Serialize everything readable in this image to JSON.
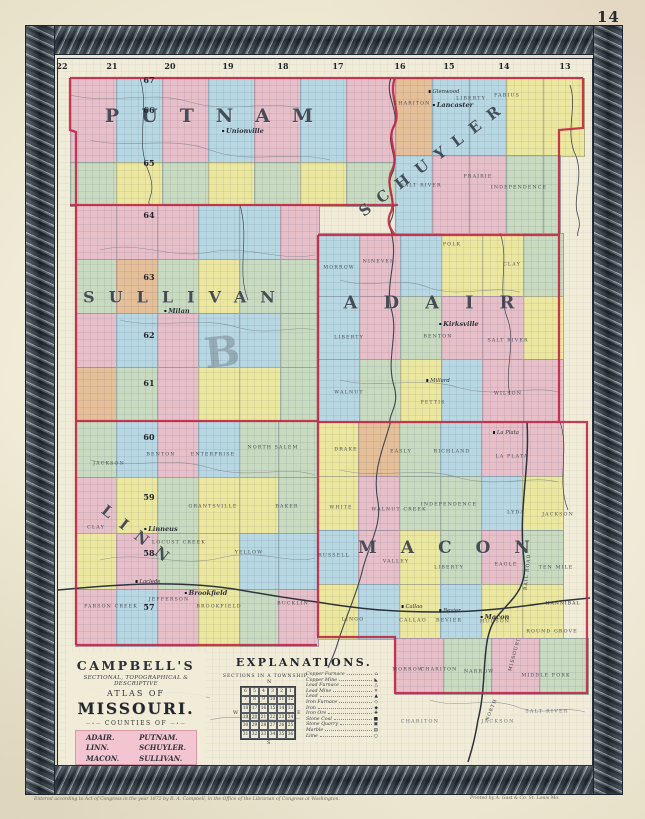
{
  "page": {
    "number": "14",
    "imprint_left": "Entered according to Act of Congress in the year 1872 by R. A. Campbell, in the Office of the Librarian of Congress at Washington.",
    "imprint_right": "Printed by A. Gast & Co. St. Louis Mo."
  },
  "palette": {
    "P": "#e7bfc9",
    "B": "#b7d7e2",
    "Y": "#ece79f",
    "G": "#c8dabf",
    "T": "#e4bf98",
    "red": "#c02845",
    "ink": "#3b4148"
  },
  "map": {
    "range_numbers": [
      [
        "22",
        62
      ],
      [
        "21",
        112
      ],
      [
        "20",
        170
      ],
      [
        "19",
        228
      ],
      [
        "18",
        283
      ],
      [
        "17",
        338
      ],
      [
        "16",
        400
      ],
      [
        "15",
        449
      ],
      [
        "14",
        504
      ],
      [
        "13",
        565
      ]
    ],
    "township_numbers": [
      [
        "67",
        80
      ],
      [
        "66",
        110
      ],
      [
        "65",
        163
      ],
      [
        "64",
        215
      ],
      [
        "63",
        277
      ],
      [
        "62",
        335
      ],
      [
        "61",
        383
      ],
      [
        "60",
        437
      ],
      [
        "59",
        497
      ],
      [
        "58",
        553
      ],
      [
        "57",
        607
      ]
    ],
    "counties": [
      [
        "PUTNAM",
        220,
        116,
        19,
        22,
        0
      ],
      [
        "SCHUYLER",
        434,
        158,
        15,
        11,
        -37
      ],
      [
        "ADAIR",
        442,
        303,
        18,
        26,
        0
      ],
      [
        "SULLIVAN",
        186,
        297,
        16,
        14,
        0
      ],
      [
        "LINN",
        140,
        537,
        15,
        12,
        38
      ],
      [
        "MACON",
        456,
        548,
        17,
        24,
        0
      ]
    ],
    "townships": [
      [
        "CHARITON",
        412,
        104
      ],
      [
        "LIBERTY",
        471,
        99
      ],
      [
        "FABIUS",
        507,
        96
      ],
      [
        "SALT RIVER",
        421,
        186
      ],
      [
        "PRAIRIE",
        478,
        177
      ],
      [
        "INDEPENDENCE",
        519,
        188
      ],
      [
        "MORROW",
        339,
        268
      ],
      [
        "NINEVEH",
        379,
        262
      ],
      [
        "POLK",
        452,
        245
      ],
      [
        "CLAY",
        512,
        265
      ],
      [
        "LIBERTY",
        349,
        338
      ],
      [
        "BENTON",
        438,
        337
      ],
      [
        "SALT RIVER",
        508,
        341
      ],
      [
        "WALNUT",
        349,
        393
      ],
      [
        "PETTIS",
        433,
        403
      ],
      [
        "WILSON",
        508,
        394
      ],
      [
        "JACKSON",
        109,
        464
      ],
      [
        "BENTON",
        161,
        455
      ],
      [
        "ENTERPRISE",
        213,
        455
      ],
      [
        "NORTH SALEM",
        273,
        448
      ],
      [
        "CLAY",
        96,
        528
      ],
      [
        "GRANTSVILLE",
        213,
        507
      ],
      [
        "BAKER",
        287,
        507
      ],
      [
        "LOCUST CREEK",
        179,
        543
      ],
      [
        "YELLOW",
        249,
        553
      ],
      [
        "PARSON CREEK",
        111,
        607
      ],
      [
        "JEFFERSON",
        169,
        600
      ],
      [
        "BROOKFIELD",
        219,
        607
      ],
      [
        "BUCKLIN",
        293,
        604
      ],
      [
        "DRAKE",
        346,
        450
      ],
      [
        "EASLY",
        401,
        452
      ],
      [
        "RICHLAND",
        452,
        452
      ],
      [
        "LA PLATA",
        512,
        457
      ],
      [
        "WHITE",
        341,
        508
      ],
      [
        "WALNUT CREEK",
        399,
        510
      ],
      [
        "INDEPENDENCE",
        449,
        505
      ],
      [
        "LYDA",
        516,
        513
      ],
      [
        "JACKSON",
        558,
        515
      ],
      [
        "RUSSELL",
        334,
        556
      ],
      [
        "VALLEY",
        396,
        562
      ],
      [
        "LIBERTY",
        449,
        568
      ],
      [
        "EAGLE",
        506,
        565
      ],
      [
        "TEN MILE",
        556,
        568
      ],
      [
        "LINGO",
        353,
        620
      ],
      [
        "CALLAO",
        413,
        621
      ],
      [
        "BEVIER",
        449,
        621
      ],
      [
        "HUDSON",
        495,
        622
      ],
      [
        "ROUND GROVE",
        552,
        632
      ],
      [
        "MORROW",
        408,
        670
      ],
      [
        "CHARITON",
        439,
        670
      ],
      [
        "NARROW",
        479,
        672
      ],
      [
        "MIDDLE FORK",
        546,
        676
      ]
    ],
    "towns": [
      [
        "Unionville",
        243,
        131,
        1
      ],
      [
        "Glenwood",
        444,
        92,
        0
      ],
      [
        "Lancaster",
        453,
        105,
        1
      ],
      [
        "Milan",
        177,
        311,
        1
      ],
      [
        "Kirksville",
        459,
        324,
        1
      ],
      [
        "Millard",
        438,
        381,
        0
      ],
      [
        "Linneus",
        161,
        529,
        1
      ],
      [
        "Laclede",
        148,
        582,
        0
      ],
      [
        "Brookfield",
        206,
        593,
        1
      ],
      [
        "La Plata",
        506,
        433,
        0
      ],
      [
        "Callao",
        412,
        607,
        0
      ],
      [
        "Bevier",
        450,
        611,
        0
      ],
      [
        "Macon",
        495,
        617,
        1
      ]
    ],
    "margin_labels": [
      [
        "CHARITON",
        420,
        722
      ],
      [
        "JACKSON",
        498,
        722
      ],
      [
        "SALT RIVER",
        547,
        712
      ]
    ],
    "railroad_labels": [
      [
        "HANNIBAL",
        563,
        604,
        0
      ],
      [
        "RAIL ROAD",
        528,
        572,
        -84
      ],
      [
        "MISSOURI",
        515,
        655,
        -75
      ],
      [
        "NORTH",
        492,
        710,
        -68
      ]
    ],
    "ghost_letter": "B",
    "patches": [
      [
        70,
        78,
        46,
        84,
        "P"
      ],
      [
        116,
        78,
        46,
        84,
        "B"
      ],
      [
        162,
        78,
        46,
        84,
        "P"
      ],
      [
        208,
        78,
        46,
        84,
        "B"
      ],
      [
        254,
        78,
        46,
        84,
        "P"
      ],
      [
        300,
        78,
        46,
        84,
        "B"
      ],
      [
        346,
        78,
        49,
        84,
        "P"
      ],
      [
        70,
        162,
        46,
        43,
        "G"
      ],
      [
        116,
        162,
        46,
        43,
        "Y"
      ],
      [
        162,
        162,
        46,
        43,
        "G"
      ],
      [
        208,
        162,
        46,
        43,
        "Y"
      ],
      [
        254,
        162,
        46,
        43,
        "G"
      ],
      [
        300,
        162,
        46,
        43,
        "Y"
      ],
      [
        346,
        162,
        49,
        43,
        "G"
      ],
      [
        395,
        78,
        37,
        77,
        "T"
      ],
      [
        432,
        78,
        37,
        77,
        "B"
      ],
      [
        469,
        78,
        37,
        77,
        "B"
      ],
      [
        506,
        78,
        37,
        77,
        "Y"
      ],
      [
        543,
        78,
        40,
        77,
        "Y"
      ],
      [
        395,
        155,
        37,
        78,
        "B"
      ],
      [
        432,
        155,
        37,
        78,
        "P"
      ],
      [
        469,
        155,
        37,
        78,
        "P"
      ],
      [
        506,
        155,
        37,
        78,
        "G"
      ],
      [
        543,
        155,
        16,
        78,
        "G"
      ],
      [
        75,
        205,
        41,
        54,
        "P"
      ],
      [
        116,
        205,
        41,
        54,
        "P"
      ],
      [
        157,
        205,
        41,
        54,
        "P"
      ],
      [
        198,
        205,
        41,
        54,
        "B"
      ],
      [
        239,
        205,
        41,
        54,
        "B"
      ],
      [
        280,
        205,
        38,
        54,
        "P"
      ],
      [
        75,
        259,
        41,
        54,
        "G"
      ],
      [
        116,
        259,
        41,
        54,
        "T"
      ],
      [
        157,
        259,
        41,
        54,
        "G"
      ],
      [
        198,
        259,
        41,
        54,
        "Y"
      ],
      [
        239,
        259,
        41,
        54,
        "G"
      ],
      [
        280,
        259,
        38,
        54,
        "G"
      ],
      [
        75,
        313,
        41,
        54,
        "P"
      ],
      [
        116,
        313,
        41,
        54,
        "B"
      ],
      [
        157,
        313,
        41,
        54,
        "P"
      ],
      [
        198,
        313,
        41,
        54,
        "B"
      ],
      [
        239,
        313,
        41,
        54,
        "B"
      ],
      [
        280,
        313,
        38,
        54,
        "G"
      ],
      [
        75,
        367,
        41,
        54,
        "T"
      ],
      [
        116,
        367,
        41,
        54,
        "G"
      ],
      [
        157,
        367,
        41,
        54,
        "P"
      ],
      [
        198,
        367,
        41,
        54,
        "Y"
      ],
      [
        239,
        367,
        41,
        54,
        "Y"
      ],
      [
        280,
        367,
        38,
        54,
        "G"
      ],
      [
        318,
        233,
        41,
        63,
        "B"
      ],
      [
        359,
        233,
        41,
        63,
        "P"
      ],
      [
        400,
        233,
        41,
        63,
        "B"
      ],
      [
        441,
        233,
        41,
        63,
        "Y"
      ],
      [
        482,
        233,
        41,
        63,
        "Y"
      ],
      [
        523,
        233,
        39,
        63,
        "G"
      ],
      [
        318,
        296,
        41,
        63,
        "B"
      ],
      [
        359,
        296,
        41,
        63,
        "P"
      ],
      [
        400,
        296,
        41,
        63,
        "G"
      ],
      [
        441,
        296,
        41,
        63,
        "P"
      ],
      [
        482,
        296,
        41,
        63,
        "P"
      ],
      [
        523,
        296,
        39,
        63,
        "Y"
      ],
      [
        318,
        359,
        41,
        63,
        "B"
      ],
      [
        359,
        359,
        41,
        63,
        "G"
      ],
      [
        400,
        359,
        41,
        63,
        "Y"
      ],
      [
        441,
        359,
        41,
        63,
        "B"
      ],
      [
        482,
        359,
        41,
        63,
        "P"
      ],
      [
        523,
        359,
        39,
        63,
        "P"
      ],
      [
        75,
        421,
        41,
        56,
        "G"
      ],
      [
        116,
        421,
        41,
        56,
        "B"
      ],
      [
        157,
        421,
        41,
        56,
        "P"
      ],
      [
        198,
        421,
        41,
        56,
        "B"
      ],
      [
        239,
        421,
        39,
        56,
        "G"
      ],
      [
        278,
        421,
        39,
        56,
        "G"
      ],
      [
        75,
        477,
        41,
        56,
        "P"
      ],
      [
        116,
        477,
        41,
        56,
        "Y"
      ],
      [
        157,
        477,
        41,
        56,
        "G"
      ],
      [
        198,
        477,
        41,
        56,
        "Y"
      ],
      [
        239,
        477,
        39,
        56,
        "Y"
      ],
      [
        278,
        477,
        39,
        56,
        "G"
      ],
      [
        75,
        533,
        41,
        56,
        "Y"
      ],
      [
        116,
        533,
        41,
        56,
        "P"
      ],
      [
        157,
        533,
        41,
        56,
        "G"
      ],
      [
        198,
        533,
        41,
        56,
        "Y"
      ],
      [
        239,
        533,
        39,
        56,
        "B"
      ],
      [
        278,
        533,
        39,
        56,
        "B"
      ],
      [
        75,
        589,
        41,
        56,
        "P"
      ],
      [
        116,
        589,
        41,
        56,
        "B"
      ],
      [
        157,
        589,
        41,
        56,
        "P"
      ],
      [
        198,
        589,
        41,
        56,
        "Y"
      ],
      [
        239,
        589,
        39,
        56,
        "G"
      ],
      [
        278,
        589,
        39,
        56,
        "P"
      ],
      [
        317,
        422,
        41,
        54,
        "Y"
      ],
      [
        358,
        422,
        41,
        54,
        "T"
      ],
      [
        399,
        422,
        41,
        54,
        "G"
      ],
      [
        440,
        422,
        41,
        54,
        "B"
      ],
      [
        481,
        422,
        41,
        54,
        "P"
      ],
      [
        522,
        422,
        40,
        54,
        "P"
      ],
      [
        317,
        476,
        41,
        54,
        "Y"
      ],
      [
        358,
        476,
        41,
        54,
        "P"
      ],
      [
        399,
        476,
        41,
        54,
        "G"
      ],
      [
        440,
        476,
        41,
        54,
        "G"
      ],
      [
        481,
        476,
        41,
        54,
        "B"
      ],
      [
        522,
        476,
        40,
        54,
        "Y"
      ],
      [
        317,
        530,
        41,
        54,
        "B"
      ],
      [
        358,
        530,
        41,
        54,
        "P"
      ],
      [
        399,
        530,
        41,
        54,
        "Y"
      ],
      [
        440,
        530,
        41,
        54,
        "G"
      ],
      [
        481,
        530,
        41,
        54,
        "P"
      ],
      [
        522,
        530,
        40,
        54,
        "G"
      ],
      [
        317,
        584,
        41,
        54,
        "Y"
      ],
      [
        358,
        584,
        41,
        54,
        "B"
      ],
      [
        399,
        584,
        41,
        54,
        "Y"
      ],
      [
        440,
        584,
        41,
        54,
        "B"
      ],
      [
        481,
        584,
        41,
        54,
        "Y"
      ],
      [
        522,
        584,
        40,
        54,
        "Y"
      ],
      [
        395,
        638,
        48,
        55,
        "P"
      ],
      [
        443,
        638,
        48,
        55,
        "G"
      ],
      [
        491,
        638,
        48,
        55,
        "P"
      ],
      [
        539,
        638,
        48,
        55,
        "G"
      ]
    ]
  },
  "cartouche": {
    "line1": "CAMPBELL'S",
    "line2": "SECTIONAL, TOPOGRAPHICAL &",
    "line3": "DESCRIPTIVE",
    "line4": "ATLAS OF",
    "line5": "MISSOURI.",
    "line6": "COUNTIES OF",
    "counties_left": [
      "ADAIR.",
      "LINN.",
      "MACON."
    ],
    "counties_right": [
      "PUTNAM.",
      "SCHUYLER.",
      "SULLIVAN."
    ]
  },
  "explanations": {
    "title": "EXPLANATIONS.",
    "sections_title": "SECTIONS IN A TOWNSHIP.",
    "compass": {
      "n": "N",
      "s": "S",
      "e": "E",
      "w": "W"
    },
    "grid": [
      [
        "6",
        "5",
        "4",
        "3",
        "2",
        "1"
      ],
      [
        "7",
        "8",
        "9",
        "10",
        "11",
        "12"
      ],
      [
        "18",
        "17",
        "16",
        "15",
        "14",
        "13"
      ],
      [
        "19",
        "20",
        "21",
        "22",
        "23",
        "24"
      ],
      [
        "30",
        "29",
        "28",
        "27",
        "26",
        "25"
      ],
      [
        "31",
        "32",
        "33",
        "34",
        "35",
        "36"
      ]
    ],
    "items": [
      {
        "label": "Copper Furnace",
        "symbol": "⌂"
      },
      {
        "label": "Copper Mine",
        "symbol": "◣"
      },
      {
        "label": "Lead Furnace",
        "symbol": "△"
      },
      {
        "label": "Lead Mine",
        "symbol": "✕"
      },
      {
        "label": "Lead",
        "symbol": "▲"
      },
      {
        "label": "Iron Furnace",
        "symbol": "◇"
      },
      {
        "label": "Iron",
        "symbol": "◆"
      },
      {
        "label": "Iron Ore",
        "symbol": "✚"
      },
      {
        "label": "Stone Coal",
        "symbol": "■"
      },
      {
        "label": "Stone Quarry",
        "symbol": "▣"
      },
      {
        "label": "Marble",
        "symbol": "▤"
      },
      {
        "label": "Lime",
        "symbol": "○"
      }
    ]
  }
}
